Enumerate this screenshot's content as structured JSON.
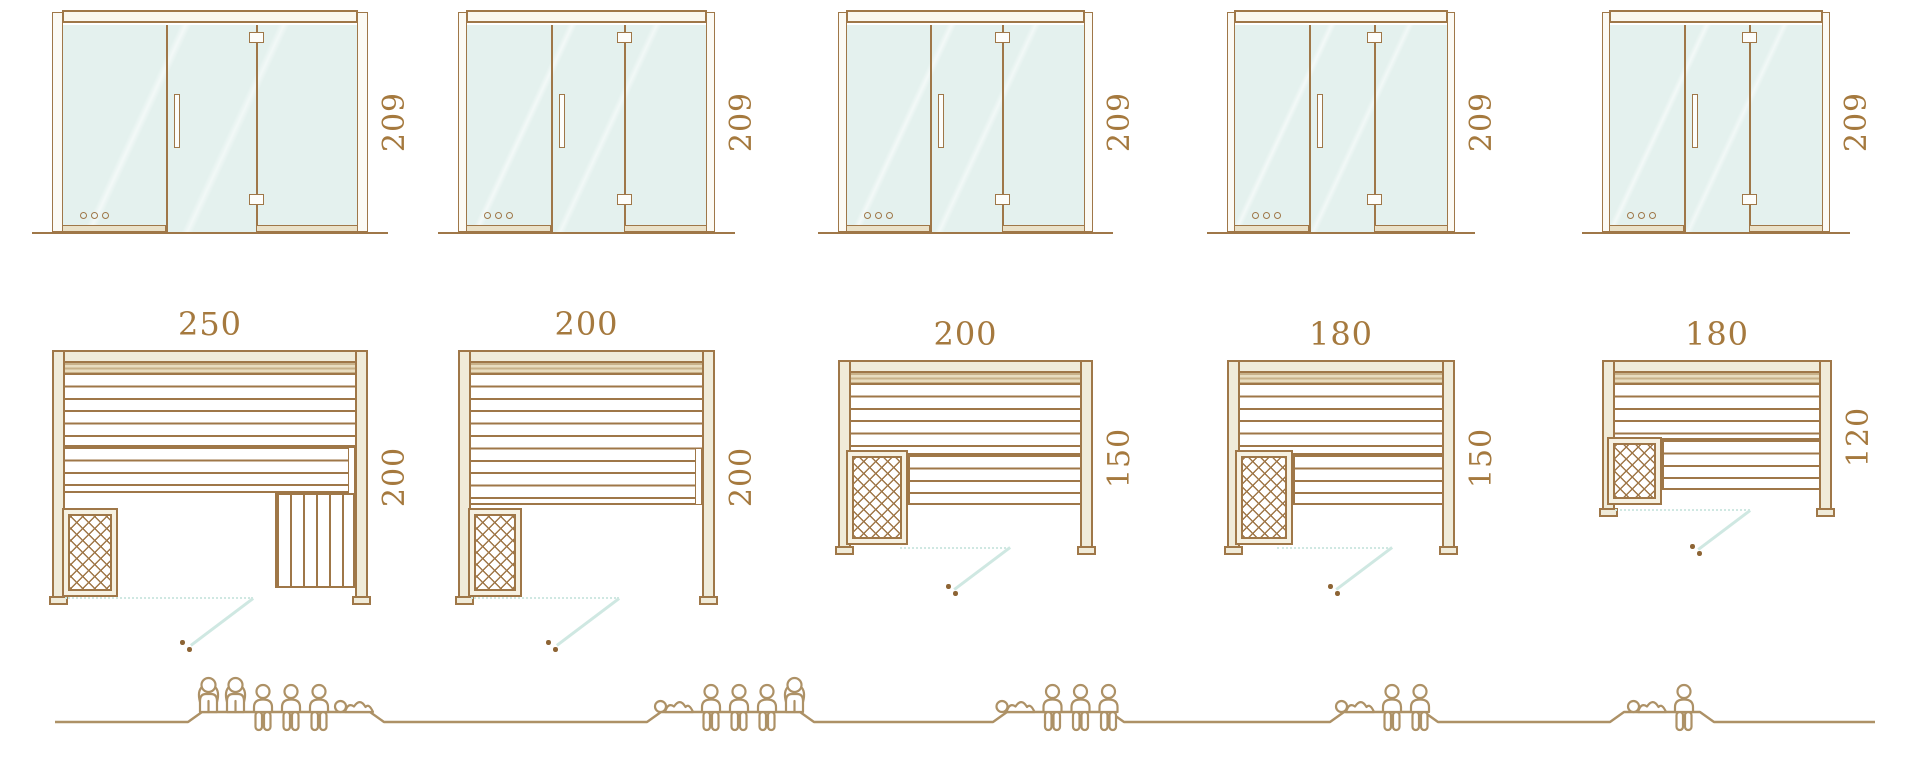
{
  "diagram_title": "sauna-size-comparison",
  "colors": {
    "line_brown": "#9f7748",
    "label_brown": "#a5793e",
    "wood_cream": "#f0ebd9",
    "glass_teal": "#e4f1ee",
    "swing_teal": "#cfe8e2",
    "people_tan": "#ad9166"
  },
  "models": [
    {
      "height_label": "209",
      "width_label": "250",
      "depth_label": "200",
      "people": [
        "standing",
        "standing",
        "sitting",
        "sitting",
        "sitting",
        "lying"
      ],
      "capacity": 6
    },
    {
      "height_label": "209",
      "width_label": "200",
      "depth_label": "200",
      "people": [
        "lying",
        "sitting",
        "sitting",
        "sitting",
        "standing"
      ],
      "capacity": 5
    },
    {
      "height_label": "209",
      "width_label": "200",
      "depth_label": "150",
      "people": [
        "lying",
        "sitting",
        "sitting",
        "sitting"
      ],
      "capacity": 4
    },
    {
      "height_label": "209",
      "width_label": "180",
      "depth_label": "150",
      "people": [
        "lying",
        "sitting",
        "sitting"
      ],
      "capacity": 3
    },
    {
      "height_label": "209",
      "width_label": "180",
      "depth_label": "120",
      "people": [
        "lying",
        "sitting"
      ],
      "capacity": 2
    }
  ]
}
